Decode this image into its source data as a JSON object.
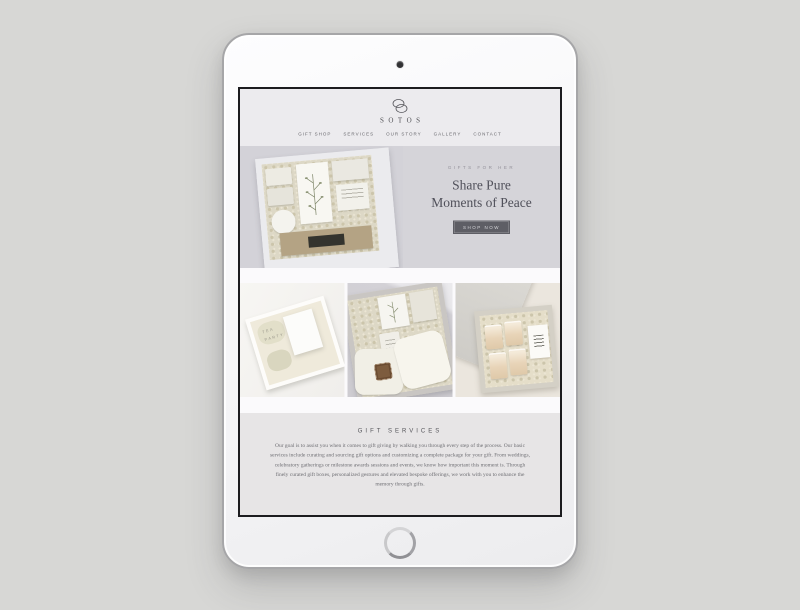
{
  "page": {
    "background": "#d7d7d5"
  },
  "device": {
    "type": "tablet-mockup",
    "camera_icon": "front-camera-dot",
    "home_button_icon": "home-button-ring"
  },
  "header": {
    "brand": "SOTOS",
    "logo_icon": "interlocking-ellipses-monogram",
    "nav": [
      {
        "label": "GIFT SHOP"
      },
      {
        "label": "SERVICES"
      },
      {
        "label": "OUR STORY"
      },
      {
        "label": "GALLERY"
      },
      {
        "label": "CONTACT"
      }
    ]
  },
  "hero": {
    "eyebrow": "GIFTS FOR HER",
    "heading_line1": "Share Pure",
    "heading_line2": "Moments of Peace",
    "cta_label": "SHOP NOW",
    "image": "gift-box-with-candles-botanical-card-and-kraft-box"
  },
  "gallery": {
    "items": [
      {
        "name": "tea-party-gift-box",
        "overlay_text": "TEA PARTY"
      },
      {
        "name": "blanket-and-leather-patch-gift-box",
        "overlay_text": ""
      },
      {
        "name": "open-box-with-candles-and-card",
        "overlay_text": ""
      }
    ]
  },
  "services": {
    "heading": "GIFT SERVICES",
    "body": "Our goal is to assist you when it comes to gift giving by walking you through every step of the process. Our basic services include curating and sourcing gift options and customizing a complete package for your gift.  From weddings, celebratory gatherings or milestone awards sessions and events, we know how important this moment is. Through finely curated gift boxes, personalized gestures and elevated bespoke offerings, we work with you to enhance the memory through gifts."
  },
  "colors": {
    "page_bg": "#d7d7d5",
    "header_bg": "#ecebee",
    "hero_bg": "#d5d4d9",
    "cta_bg": "#5e5e65",
    "cta_text": "#d6d6da",
    "services_bg": "#e7e5e6",
    "screen_bg": "#fbfafc",
    "bezel": "#1c1c1f"
  }
}
